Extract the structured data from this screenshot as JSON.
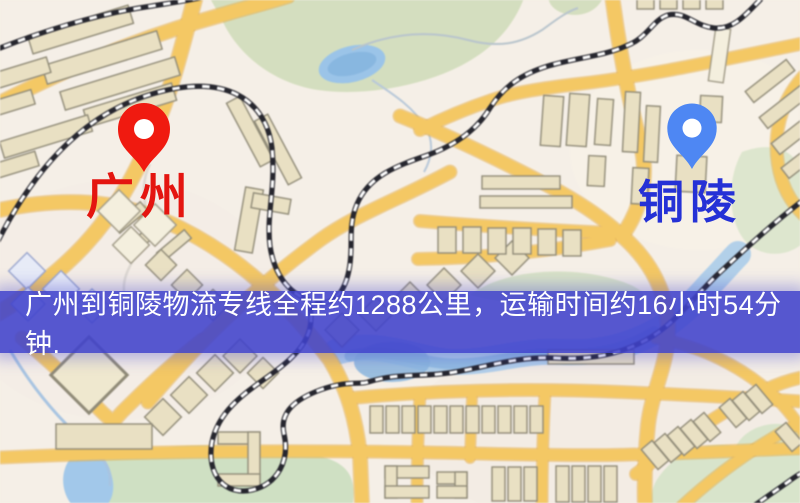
{
  "map": {
    "origin": {
      "label": "广州",
      "pin": "red-location-pin"
    },
    "destination": {
      "label": "铜陵",
      "pin": "blue-location-pin"
    }
  },
  "banner": {
    "text": "广州到铜陵物流专线全程约1288公里，运输时间约16小时54分钟."
  },
  "colors": {
    "pin_red": "#f01a10",
    "pin_blue": "#4e87f3",
    "origin_label": "#e41510",
    "destination_label": "#2531d6",
    "banner_bg": "rgba(64,66,204,0.88)",
    "banner_text": "#ffffff",
    "road_fill": "#f2c868",
    "road_casing": "#e2ae52",
    "water": "#a3c8e8",
    "water_deep": "#8cb6dc",
    "park": "#d4dec0",
    "building_fill": "#e9e0c4",
    "building_stroke": "#8f8a78",
    "railway_dark": "#26262e",
    "railway_light": "#ffffff",
    "background": "#f5efe7"
  }
}
